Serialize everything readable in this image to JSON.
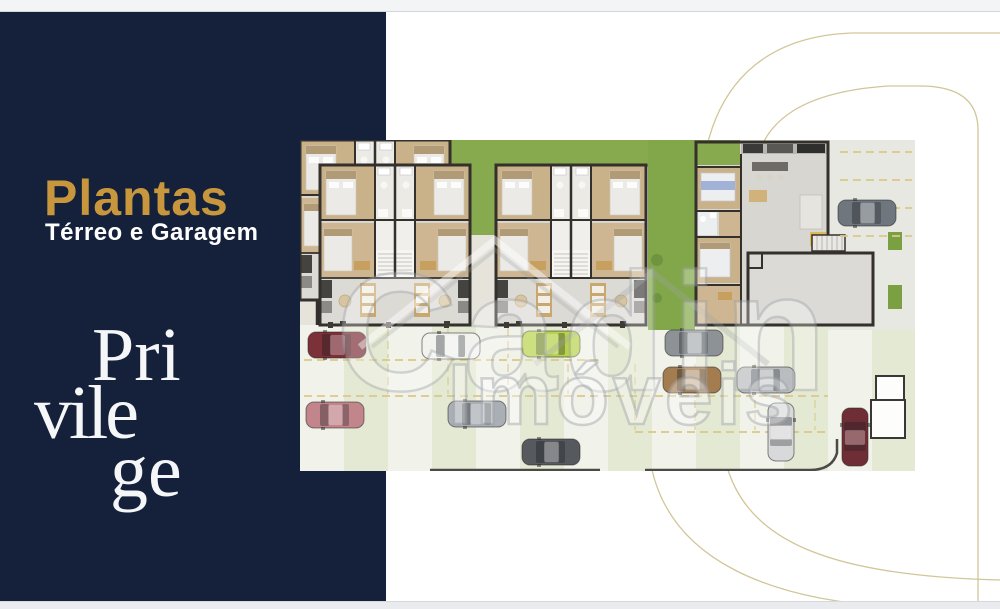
{
  "window": {
    "top_bar_color": "#f3f4f6",
    "bottom_bar_color": "#e9ebee",
    "background": "#ffffff"
  },
  "sidebar": {
    "background": "#15213a",
    "title": "Plantas",
    "title_color": "#c8973d",
    "subtitle": "Térreo e Garagem",
    "subtitle_color": "#ffffff",
    "logo": {
      "lines": [
        "Pri",
        "vile",
        "ge"
      ],
      "color": "#f4f6f8"
    }
  },
  "plan": {
    "description": "floor-plan-terreo-e-garagem",
    "palette": {
      "grass": "#86aa4d",
      "grass_dark": "#7ba041",
      "wall": "#34302b",
      "bedroom_floor": "#c9b18a",
      "bath_floor": "#eceae5",
      "ground_floor": "#dcdad5",
      "counter": "#c9a86f",
      "garage_light": "#f1f2ea",
      "garage_green": "#e4e9d3",
      "parking_marking": "#dbc98b",
      "driveway": "#e7e8e2",
      "hall_room": "#dbdad6"
    },
    "cars": [
      {
        "x": 8,
        "y": 192,
        "dir": "h",
        "color": "#7c3038",
        "label": "dark-red-car"
      },
      {
        "x": 122,
        "y": 193,
        "dir": "h",
        "color": "#f2f2ef",
        "label": "white-car"
      },
      {
        "x": 222,
        "y": 191,
        "dir": "h",
        "color": "#b7d24d",
        "label": "lime-car"
      },
      {
        "x": 538,
        "y": 60,
        "dir": "h",
        "color": "#70767d",
        "label": "gray-car-driveway"
      },
      {
        "x": 6,
        "y": 262,
        "dir": "h",
        "color": "#c2858b",
        "label": "pink-car"
      },
      {
        "x": 148,
        "y": 261,
        "dir": "h",
        "color": "#a9afb5",
        "label": "silver-car"
      },
      {
        "x": 222,
        "y": 299,
        "dir": "h",
        "color": "#56595e",
        "label": "dark-gray-car"
      },
      {
        "x": 365,
        "y": 190,
        "dir": "h",
        "color": "#8d9296",
        "label": "gray-car"
      },
      {
        "x": 363,
        "y": 227,
        "dir": "h",
        "color": "#a37c50",
        "label": "brown-car"
      },
      {
        "x": 437,
        "y": 227,
        "dir": "h",
        "color": "#babdc0",
        "label": "silver-car-2"
      },
      {
        "x": 468,
        "y": 263,
        "dir": "v",
        "color": "#d8d9da",
        "label": "white-car-vertical"
      },
      {
        "x": 542,
        "y": 268,
        "dir": "v",
        "color": "#6f2e36",
        "label": "dark-red-car-vertical"
      }
    ]
  },
  "watermark": {
    "name": "Cadin",
    "type": "Imóveis"
  },
  "decor": {
    "arc_color": "#cdc08d"
  }
}
